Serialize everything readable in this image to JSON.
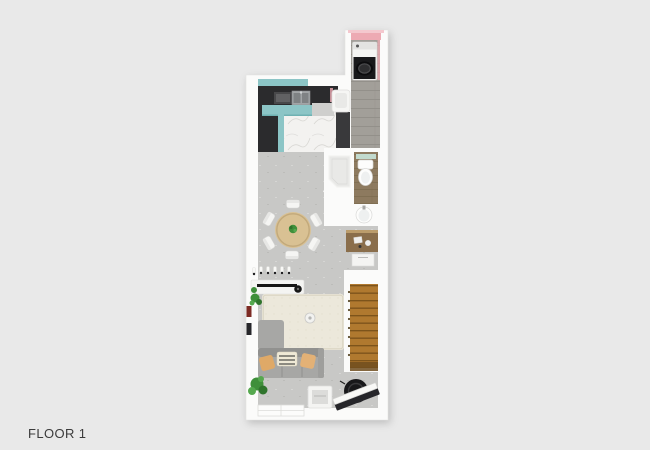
{
  "page": {
    "label": "FLOOR 1",
    "background": "#e9e9e9",
    "label_color": "#3b3b3b"
  },
  "floor_plan": {
    "floor_name": "FLOOR 1",
    "elements": [
      "washing-machine",
      "laundry-corridor",
      "kitchen-counter",
      "kitchen-sink",
      "cooktop",
      "tall-cabinet",
      "wash-basin",
      "shower",
      "toilet",
      "vanity-sink",
      "dressing-desk",
      "drawer-unit",
      "dining-table",
      "dining-chairs",
      "wall-hooks",
      "sideboard",
      "tv-bar",
      "rug",
      "ceiling-lamp",
      "sofa",
      "cushions",
      "throw-blanket",
      "plants",
      "picture-table",
      "staircase",
      "round-black-chair",
      "entry-door",
      "window"
    ]
  },
  "palette": {
    "background": "#e9e9e9",
    "wall_white": "#fbfbfa",
    "accent_pink": "#edaab3",
    "cabinet_teal": "#8cc5c6",
    "counter_dark": "#2b2b2d",
    "marble_white": "#f3f2f0",
    "floor_concrete": "#c8c8c6",
    "wood_corridor": "#a29f99",
    "wood_bathroom": "#8d7a5f",
    "wood_stairs": "#b0792f",
    "wood_desk": "#8a6e4b",
    "sofa_gray": "#a7a7a5",
    "rug_cream": "#ece8db",
    "table_tan": "#d9c193",
    "cushion_tan": "#dfa967",
    "plant_green": "#3f8f3a",
    "appliance_black": "#1a1a1c"
  }
}
